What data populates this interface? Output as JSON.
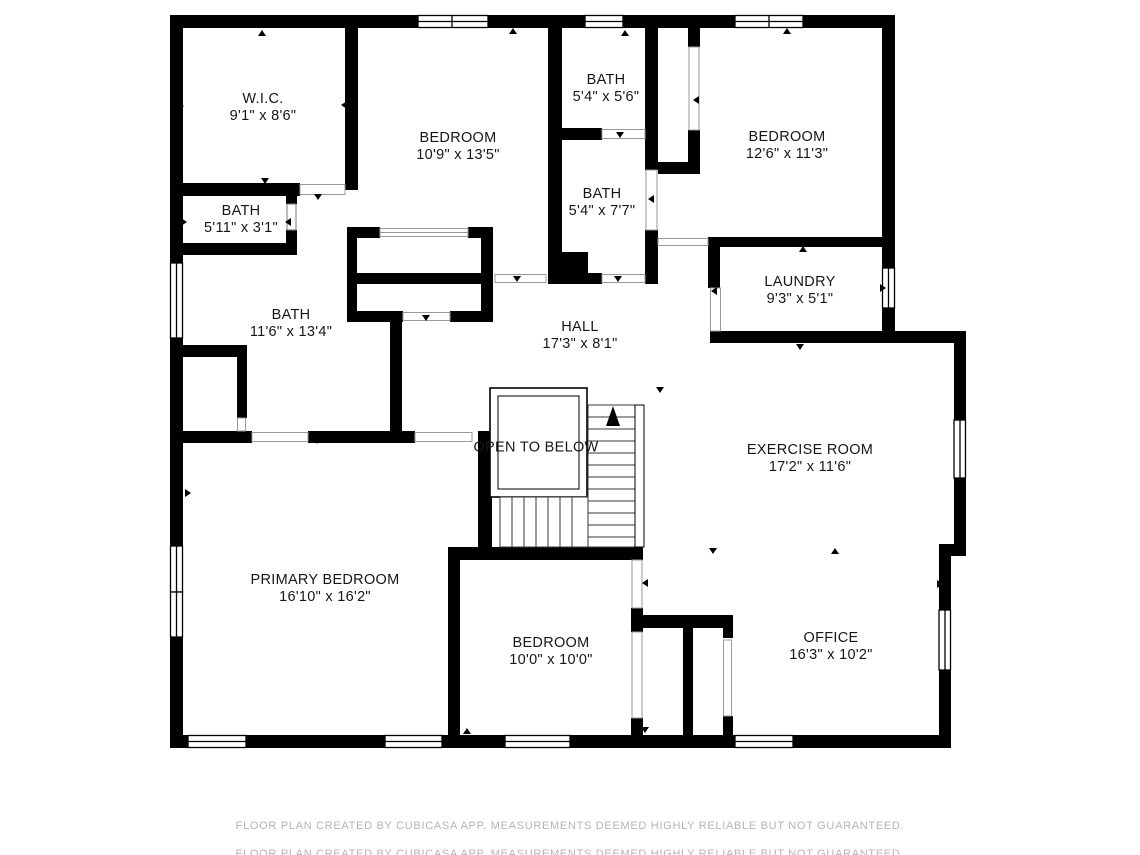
{
  "rooms": [
    {
      "name": "W.I.C.",
      "dims": "9'1\" x 8'6\""
    },
    {
      "name": "BEDROOM",
      "dims": "10'9\" x 13'5\""
    },
    {
      "name": "BATH",
      "dims": "5'4\" x 5'6\""
    },
    {
      "name": "BEDROOM",
      "dims": "12'6\" x 11'3\""
    },
    {
      "name": "BATH",
      "dims": "5'11\" x 3'1\""
    },
    {
      "name": "BATH",
      "dims": "5'4\" x 7'7\""
    },
    {
      "name": "LAUNDRY",
      "dims": "9'3\" x 5'1\""
    },
    {
      "name": "BATH",
      "dims": "11'6\" x 13'4\""
    },
    {
      "name": "HALL",
      "dims": "17'3\" x 8'1\""
    },
    {
      "name": "OPEN TO BELOW",
      "dims": ""
    },
    {
      "name": "EXERCISE ROOM",
      "dims": "17'2\" x 11'6\""
    },
    {
      "name": "PRIMARY BEDROOM",
      "dims": "16'10\" x 16'2\""
    },
    {
      "name": "BEDROOM",
      "dims": "10'0\" x 10'0\""
    },
    {
      "name": "OFFICE",
      "dims": "16'3\" x 10'2\""
    }
  ],
  "footer": {
    "line1": "FLOOR PLAN CREATED BY CUBICASA APP. MEASUREMENTS DEEMED HIGHLY RELIABLE BUT NOT GUARANTEED.",
    "line2": "FLOOR PLAN CREATED BY CUBICASA APP. MEASUREMENTS DEEMED HIGHLY RELIABLE BUT NOT GUARANTEED."
  },
  "colors": {
    "wall": "#000000",
    "label": "#161616",
    "footer_text": "#b4b4b4",
    "background": "#ffffff"
  }
}
